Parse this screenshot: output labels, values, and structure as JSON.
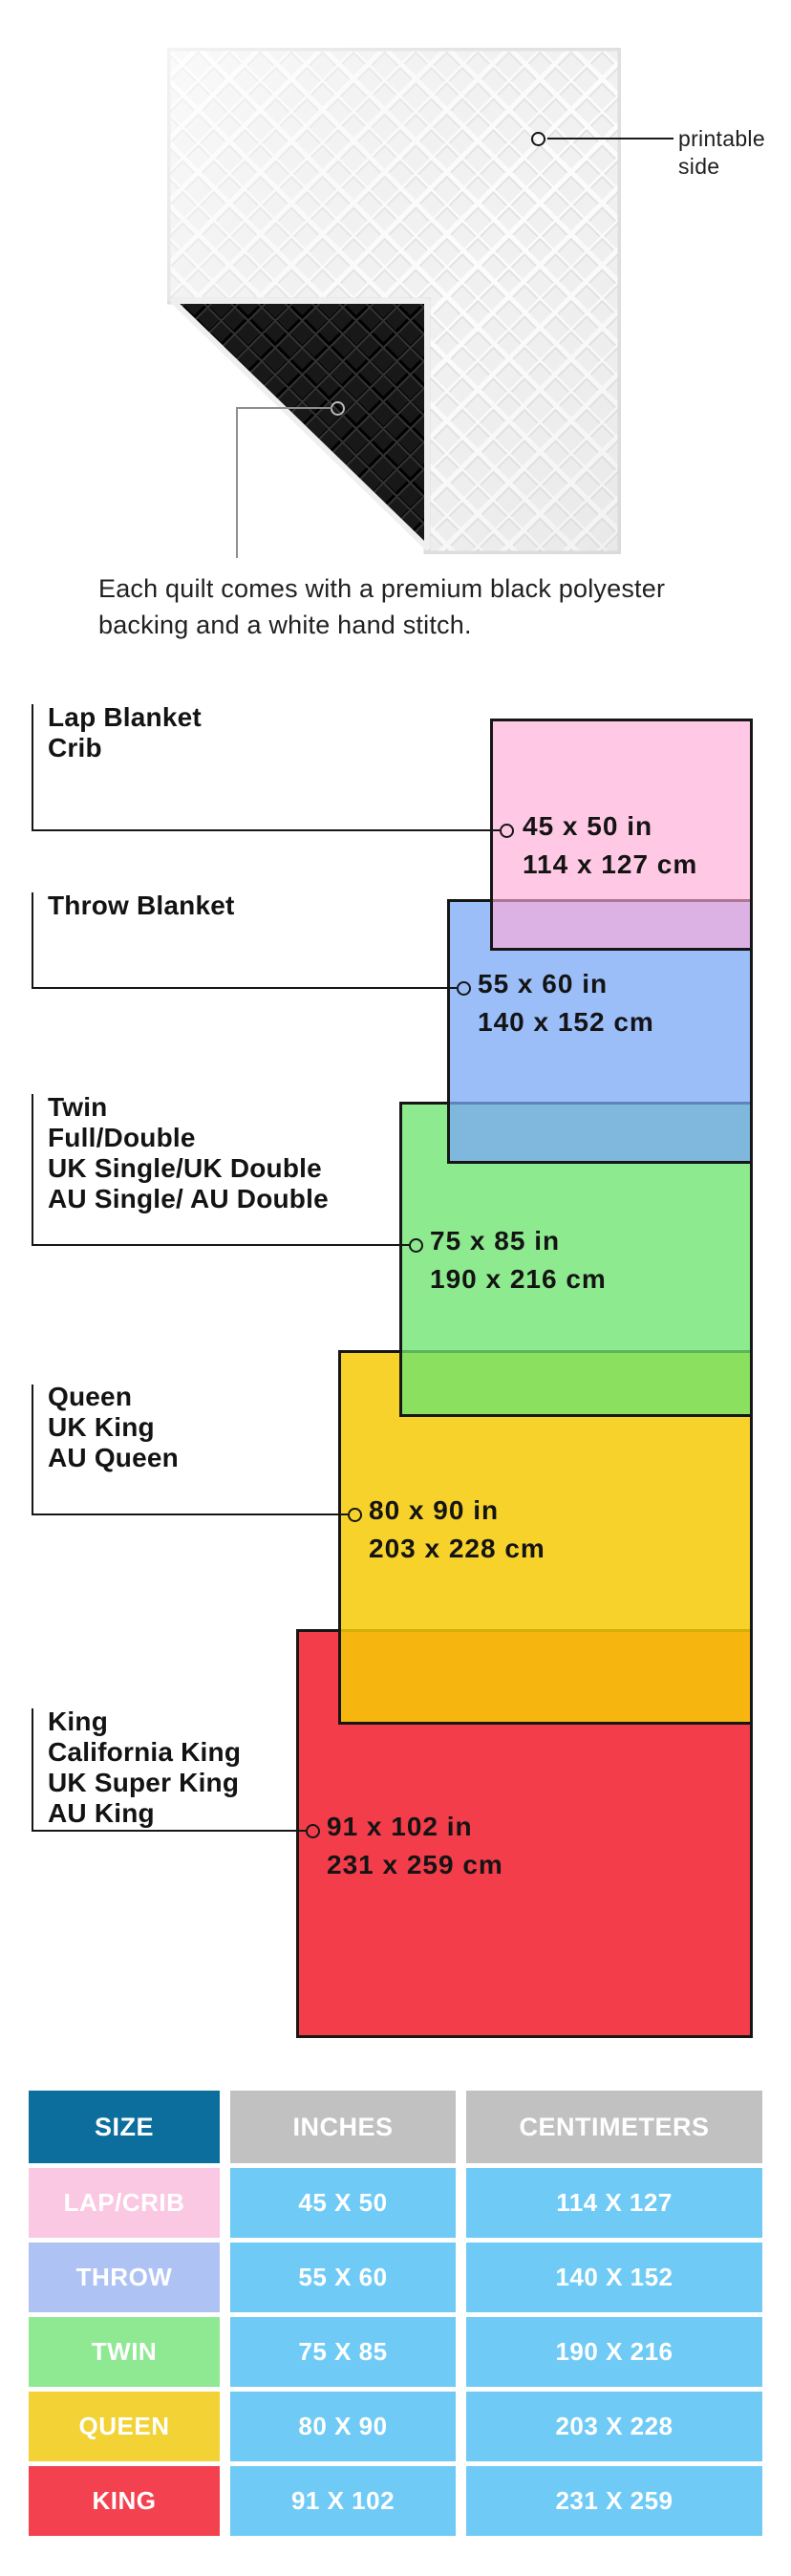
{
  "quilt": {
    "printable_label_lines": [
      "printable",
      "side"
    ],
    "backing_caption_lines": [
      "Each quilt comes with a premium black polyester",
      "backing and a white hand stitch."
    ]
  },
  "diagram": {
    "sizes": [
      {
        "id": "lap",
        "label_lines": [
          "Lap Blanket",
          "Crib"
        ],
        "inches": "45 x 50 in",
        "cm": "114 x 127 cm",
        "color": "#FFC7E5"
      },
      {
        "id": "throw",
        "label_lines": [
          "Throw Blanket"
        ],
        "inches": "55 x 60 in",
        "cm": "140 x 152 cm",
        "color": "#A0BEF8"
      },
      {
        "id": "twin",
        "label_lines": [
          "Twin",
          "Full/Double",
          "UK Single/UK Double",
          "AU Single/ AU Double"
        ],
        "inches": "75 x 85 in",
        "cm": "190 x 216 cm",
        "color": "#8FE993"
      },
      {
        "id": "queen",
        "label_lines": [
          "Queen",
          "UK King",
          "AU Queen"
        ],
        "inches": "80 x 90 in",
        "cm": "203 x 228 cm",
        "color": "#F6D63D"
      },
      {
        "id": "king",
        "label_lines": [
          "King",
          "California King",
          "UK Super King",
          "AU King"
        ],
        "inches": "91 x 102 in",
        "cm": "231 x 259 cm",
        "color": "#F4455A"
      }
    ],
    "overlap_colors": {
      "lap_over_throw": "#DDB3E3",
      "throw_over_twin": "#7FB7DC",
      "twin_over_queen": "#8FDC58",
      "queen_over_king": "#F3A92B"
    }
  },
  "table": {
    "headers": [
      "SIZE",
      "INCHES",
      "CENTIMETERS"
    ],
    "header_colors": {
      "size_bg": "#0C6E9D",
      "others_bg": "#C1C1C1"
    },
    "value_cell_bg": "#6FCBF6",
    "rows": [
      {
        "size": "LAP/CRIB",
        "inches": "45 X 50",
        "cm": "114 X 127",
        "color": "#FAC8E2"
      },
      {
        "size": "THROW",
        "inches": "55 X 60",
        "cm": "140 X 152",
        "color": "#AEC3F4"
      },
      {
        "size": "TWIN",
        "inches": "75 X 85",
        "cm": "190 X 216",
        "color": "#8FE993"
      },
      {
        "size": "QUEEN",
        "inches": "80 X 90",
        "cm": "203 X 228",
        "color": "#F2D234"
      },
      {
        "size": "KING",
        "inches": "91 X 102",
        "cm": "231 X 259",
        "color": "#F3414F"
      }
    ]
  }
}
